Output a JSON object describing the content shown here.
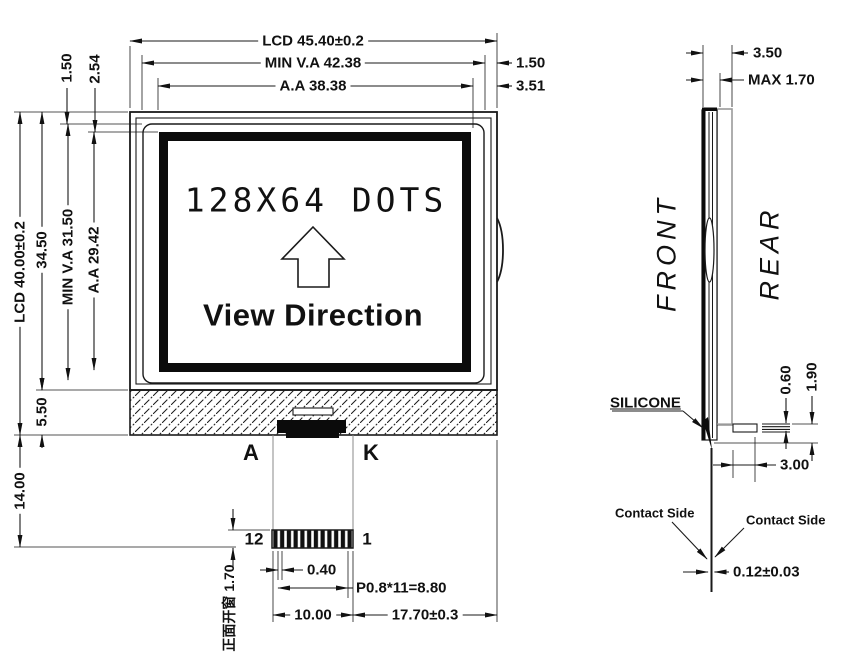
{
  "colors": {
    "ink": "#1a1a1a",
    "background": "#ffffff"
  },
  "front": {
    "top_dims": {
      "lcd_width": "LCD 45.40±0.2",
      "va_width": "MIN V.A 42.38",
      "aa_width": "A.A 38.38",
      "edge_to_va": "1.50",
      "edge_to_aa": "3.51"
    },
    "left_dims": {
      "edge_to_va": "1.50",
      "edge_to_aa": "2.54",
      "lcd_height": "LCD 40.00±0.2",
      "glass_height": "34.50",
      "va_height": "MIN V.A 31.50",
      "aa_height": "A.A 29.42",
      "backlight_height": "5.50",
      "tail_length": "14.00"
    },
    "screen": {
      "dots_text": "128X64 DOTS",
      "view_direction": "View Direction"
    },
    "connector": {
      "anode": "A",
      "cathode": "K",
      "pin_last": "12",
      "pin_first": "1"
    },
    "bottom_dims": {
      "pin_width": "0.40",
      "pitch": "P0.8*11=8.80",
      "fpc_width": "10.00",
      "fpc_offset": "17.70±0.3",
      "window_note": "正面开窗 1.70"
    }
  },
  "side": {
    "front_label": "FRONT",
    "rear_label": "REAR",
    "silicone_label": "SILICONE",
    "contact_side_left": "Contact Side",
    "contact_side_right": "Contact Side",
    "dims": {
      "total_thickness": "3.50",
      "max_thickness": "MAX 1.70",
      "contact_thickness": "0.60",
      "contact_height": "1.90",
      "contact_length": "3.00",
      "fpc_thickness": "0.12±0.03"
    }
  }
}
